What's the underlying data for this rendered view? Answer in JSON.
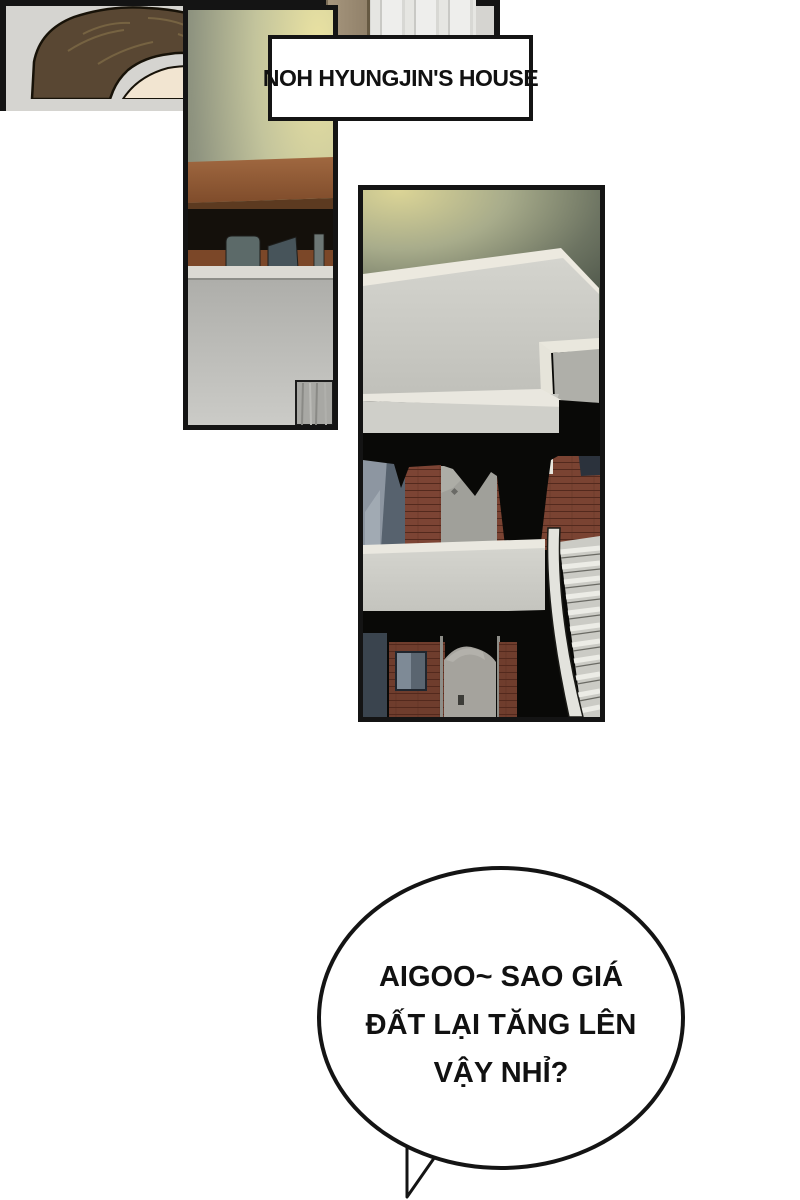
{
  "comic": {
    "caption": "NOH HYUNGJIN'S HOUSE",
    "bubble": {
      "lines": [
        "AIGOO~ SAO GIÁ",
        "ĐẤT LẠI TĂNG LÊN",
        "VẬY NHỈ?"
      ]
    },
    "panels": [
      {
        "name": "interior-shelf-panel",
        "description": "Dim room interior: lamplit wall, wooden shelf with objects, gray rooftop wall and small curtain"
      },
      {
        "name": "house-exterior-panel",
        "description": "Night view of a two-story brick house with flat white roof, balcony and outdoor staircase"
      },
      {
        "name": "listening-man-panel",
        "description": "Back of a brown-haired man's head in front of a doorway post and curtain"
      }
    ],
    "colors": {
      "lamp_glow": "#e9e1a0",
      "wall_olive": "#7e836e",
      "wood_brown": "#8a5634",
      "roof_gray": "#cdcdc7",
      "brick_red": "#7a4332",
      "window_blue": "#6b7682",
      "night_black": "#090907",
      "hair_brown": "#594733",
      "skin": "#f2e5d1",
      "panel_bg": "#d5d4d0",
      "outline": "#141414"
    }
  }
}
